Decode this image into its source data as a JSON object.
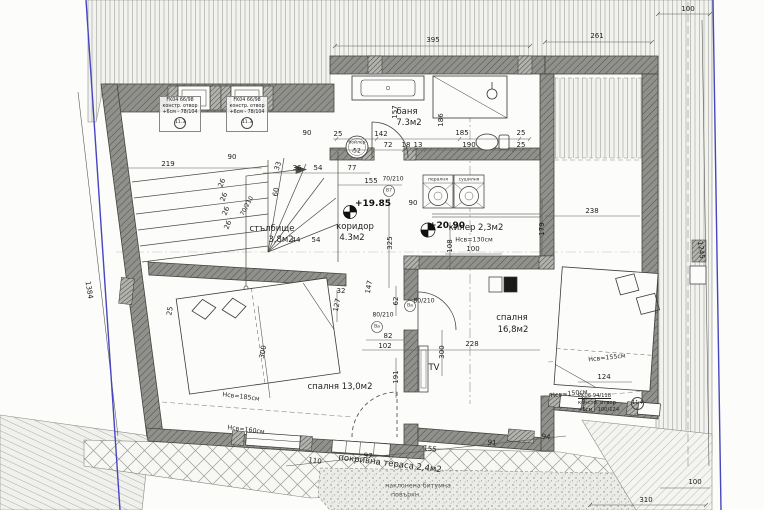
{
  "colors": {
    "boundary_blue": "#4646c0",
    "paper": "#fcfcfa"
  },
  "window_tags": [
    {
      "line1": "FK04 66/98",
      "line2": "констр. отвор",
      "line3": "+6см - 78/104",
      "mark": "11.3"
    },
    {
      "line1": "FK04 66/98",
      "line2": "констр. отвор",
      "line3": "+6см - 78/104",
      "mark": "11.3"
    },
    {
      "line1": "PK06 94/118",
      "line2": "констр. отвор",
      "line3": "+6см - 100/124",
      "mark": "11.4"
    }
  ],
  "labels": [
    {
      "t": "395",
      "x": 433,
      "y": 40,
      "cls": "dim"
    },
    {
      "t": "261",
      "x": 597,
      "y": 36,
      "cls": "dim"
    },
    {
      "t": "100",
      "x": 688,
      "y": 9,
      "cls": "dim"
    },
    {
      "t": "1245",
      "x": 701,
      "y": 250,
      "r": 83,
      "cls": "dim"
    },
    {
      "t": "1384",
      "x": 89,
      "y": 290,
      "r": 80,
      "cls": "dim"
    },
    {
      "t": "219",
      "x": 168,
      "y": 164,
      "cls": "dim"
    },
    {
      "t": "90",
      "x": 232,
      "y": 157,
      "cls": "dim"
    },
    {
      "t": "90",
      "x": 307,
      "y": 133,
      "cls": "dim"
    },
    {
      "t": "25",
      "x": 338,
      "y": 134,
      "cls": "dim"
    },
    {
      "t": "142",
      "x": 381,
      "y": 134,
      "cls": "dim"
    },
    {
      "t": "185",
      "x": 462,
      "y": 133,
      "cls": "dim"
    },
    {
      "t": "25",
      "x": 521,
      "y": 133,
      "cls": "dim"
    },
    {
      "t": "72",
      "x": 388,
      "y": 145,
      "cls": "dim"
    },
    {
      "t": "18",
      "x": 406,
      "y": 145,
      "cls": "dim"
    },
    {
      "t": "13",
      "x": 418,
      "y": 145,
      "cls": "dim"
    },
    {
      "t": "190",
      "x": 469,
      "y": 145,
      "cls": "dim"
    },
    {
      "t": "25",
      "x": 521,
      "y": 145,
      "cls": "dim"
    },
    {
      "t": "157",
      "x": 395,
      "y": 112,
      "r": -90,
      "cls": "dim"
    },
    {
      "t": "186",
      "x": 441,
      "y": 120,
      "r": -90,
      "cls": "dim"
    },
    {
      "t": "77",
      "x": 352,
      "y": 168,
      "cls": "dim"
    },
    {
      "t": "155",
      "x": 371,
      "y": 181,
      "cls": "dim"
    },
    {
      "t": "36",
      "x": 297,
      "y": 168,
      "cls": "dim"
    },
    {
      "t": "54",
      "x": 318,
      "y": 168,
      "cls": "dim"
    },
    {
      "t": "33",
      "x": 278,
      "y": 166,
      "r": -72,
      "cls": "dim"
    },
    {
      "t": "60",
      "x": 276,
      "y": 192,
      "r": -80,
      "cls": "dim"
    },
    {
      "t": "26",
      "x": 222,
      "y": 183,
      "r": -68,
      "cls": "dim"
    },
    {
      "t": "26",
      "x": 224,
      "y": 197,
      "r": -68,
      "cls": "dim"
    },
    {
      "t": "26",
      "x": 226,
      "y": 211,
      "r": -68,
      "cls": "dim"
    },
    {
      "t": "26",
      "x": 228,
      "y": 225,
      "r": -68,
      "cls": "dim"
    },
    {
      "t": "44",
      "x": 296,
      "y": 240,
      "cls": "dim"
    },
    {
      "t": "54",
      "x": 316,
      "y": 240,
      "cls": "dim"
    },
    {
      "t": "325",
      "x": 390,
      "y": 243,
      "r": -90,
      "cls": "dim"
    },
    {
      "t": "147",
      "x": 369,
      "y": 287,
      "r": -80,
      "cls": "dim"
    },
    {
      "t": "108",
      "x": 450,
      "y": 246,
      "r": -90,
      "cls": "dim"
    },
    {
      "t": "100",
      "x": 473,
      "y": 249,
      "cls": "dim"
    },
    {
      "t": "90",
      "x": 413,
      "y": 203,
      "cls": "dim"
    },
    {
      "t": "179",
      "x": 542,
      "y": 229,
      "r": -90,
      "cls": "dim"
    },
    {
      "t": "238",
      "x": 592,
      "y": 211,
      "cls": "dim"
    },
    {
      "t": "62",
      "x": 396,
      "y": 301,
      "r": -90,
      "cls": "dim"
    },
    {
      "t": "82",
      "x": 388,
      "y": 336,
      "cls": "dim"
    },
    {
      "t": "102",
      "x": 385,
      "y": 346,
      "cls": "dim"
    },
    {
      "t": "228",
      "x": 472,
      "y": 344,
      "cls": "dim"
    },
    {
      "t": "300",
      "x": 442,
      "y": 352,
      "r": -90,
      "cls": "dim"
    },
    {
      "t": "191",
      "x": 396,
      "y": 377,
      "r": -90,
      "cls": "dim"
    },
    {
      "t": "300",
      "x": 263,
      "y": 352,
      "r": -80,
      "cls": "dim"
    },
    {
      "t": "32",
      "x": 341,
      "y": 291,
      "cls": "dim"
    },
    {
      "t": "127",
      "x": 337,
      "y": 305,
      "r": -78,
      "cls": "dim"
    },
    {
      "t": "25",
      "x": 170,
      "y": 311,
      "r": -80,
      "cls": "dim"
    },
    {
      "t": "124",
      "x": 604,
      "y": 377,
      "cls": "dim"
    },
    {
      "t": "310",
      "x": 646,
      "y": 500,
      "cls": "dim"
    },
    {
      "t": "100",
      "x": 695,
      "y": 482,
      "cls": "dim"
    },
    {
      "t": "110",
      "x": 315,
      "y": 461,
      "r": 7,
      "cls": "dim"
    },
    {
      "t": "97",
      "x": 368,
      "y": 456,
      "r": 7,
      "cls": "dim"
    },
    {
      "t": "155",
      "x": 430,
      "y": 449,
      "r": 7,
      "cls": "dim"
    },
    {
      "t": "91",
      "x": 492,
      "y": 443,
      "r": 7,
      "cls": "dim"
    },
    {
      "t": "94",
      "x": 546,
      "y": 437,
      "r": 7,
      "cls": "dim"
    },
    {
      "t": "Hсв=185см",
      "x": 241,
      "y": 397,
      "r": 7,
      "cls": "hsv"
    },
    {
      "t": "Hсв=160см",
      "x": 246,
      "y": 430,
      "r": 7,
      "cls": "hsv"
    },
    {
      "t": "Hсв=155см",
      "x": 607,
      "y": 358,
      "r": -6,
      "cls": "hsv"
    },
    {
      "t": "Hсв=150см",
      "x": 569,
      "y": 394,
      "r": -6,
      "cls": "hsv"
    },
    {
      "t": "Hсв=130см",
      "x": 474,
      "y": 240,
      "cls": "hsv"
    },
    {
      "t": "баня",
      "x": 407,
      "y": 112,
      "cls": "room"
    },
    {
      "t": "7.3м2",
      "x": 409,
      "y": 123,
      "cls": "room"
    },
    {
      "t": "коридор",
      "x": 355,
      "y": 227,
      "cls": "room"
    },
    {
      "t": "4.3м2",
      "x": 352,
      "y": 238,
      "cls": "room"
    },
    {
      "t": "килер 2,3м2",
      "x": 476,
      "y": 228,
      "cls": "room"
    },
    {
      "t": "спалня",
      "x": 512,
      "y": 318,
      "cls": "room"
    },
    {
      "t": "16,8м2",
      "x": 513,
      "y": 330,
      "cls": "room"
    },
    {
      "t": "спалня 13,0м2",
      "x": 340,
      "y": 387,
      "cls": "room"
    },
    {
      "t": "стълбище",
      "x": 272,
      "y": 229,
      "cls": "room"
    },
    {
      "t": "3,8м2",
      "x": 281,
      "y": 240,
      "cls": "room"
    },
    {
      "t": "покривна тераса 2,4м2",
      "x": 390,
      "y": 464,
      "r": 7,
      "cls": "room"
    },
    {
      "t": "TV",
      "x": 434,
      "y": 368,
      "cls": "room"
    },
    {
      "t": "+19.85",
      "x": 373,
      "y": 204,
      "cls": "level"
    },
    {
      "t": "+20.90",
      "x": 447,
      "y": 226,
      "cls": "level"
    },
    {
      "t": "70/210",
      "x": 393,
      "y": 179,
      "cls": "tiny"
    },
    {
      "t": "В7",
      "x": 389,
      "y": 191,
      "cls": "micro"
    },
    {
      "t": "80/210",
      "x": 383,
      "y": 315,
      "cls": "tiny"
    },
    {
      "t": "Ва",
      "x": 377,
      "y": 327,
      "cls": "micro"
    },
    {
      "t": "80/210",
      "x": 424,
      "y": 301,
      "cls": "tiny"
    },
    {
      "t": "Ва",
      "x": 410,
      "y": 306,
      "cls": "micro"
    },
    {
      "t": "70/210",
      "x": 247,
      "y": 206,
      "r": -62,
      "cls": "tiny"
    },
    {
      "t": "пералня",
      "x": 438,
      "y": 180,
      "cls": "micro"
    },
    {
      "t": "сушилня",
      "x": 469,
      "y": 180,
      "cls": "micro"
    },
    {
      "t": "бойлер",
      "x": 357,
      "y": 143,
      "cls": "micro"
    },
    {
      "t": "52",
      "x": 357,
      "y": 151,
      "cls": "tiny"
    },
    {
      "t": "наклонена битумна",
      "x": 418,
      "y": 486,
      "cls": "note"
    },
    {
      "t": "повърхн.",
      "x": 406,
      "y": 495,
      "cls": "note"
    }
  ]
}
